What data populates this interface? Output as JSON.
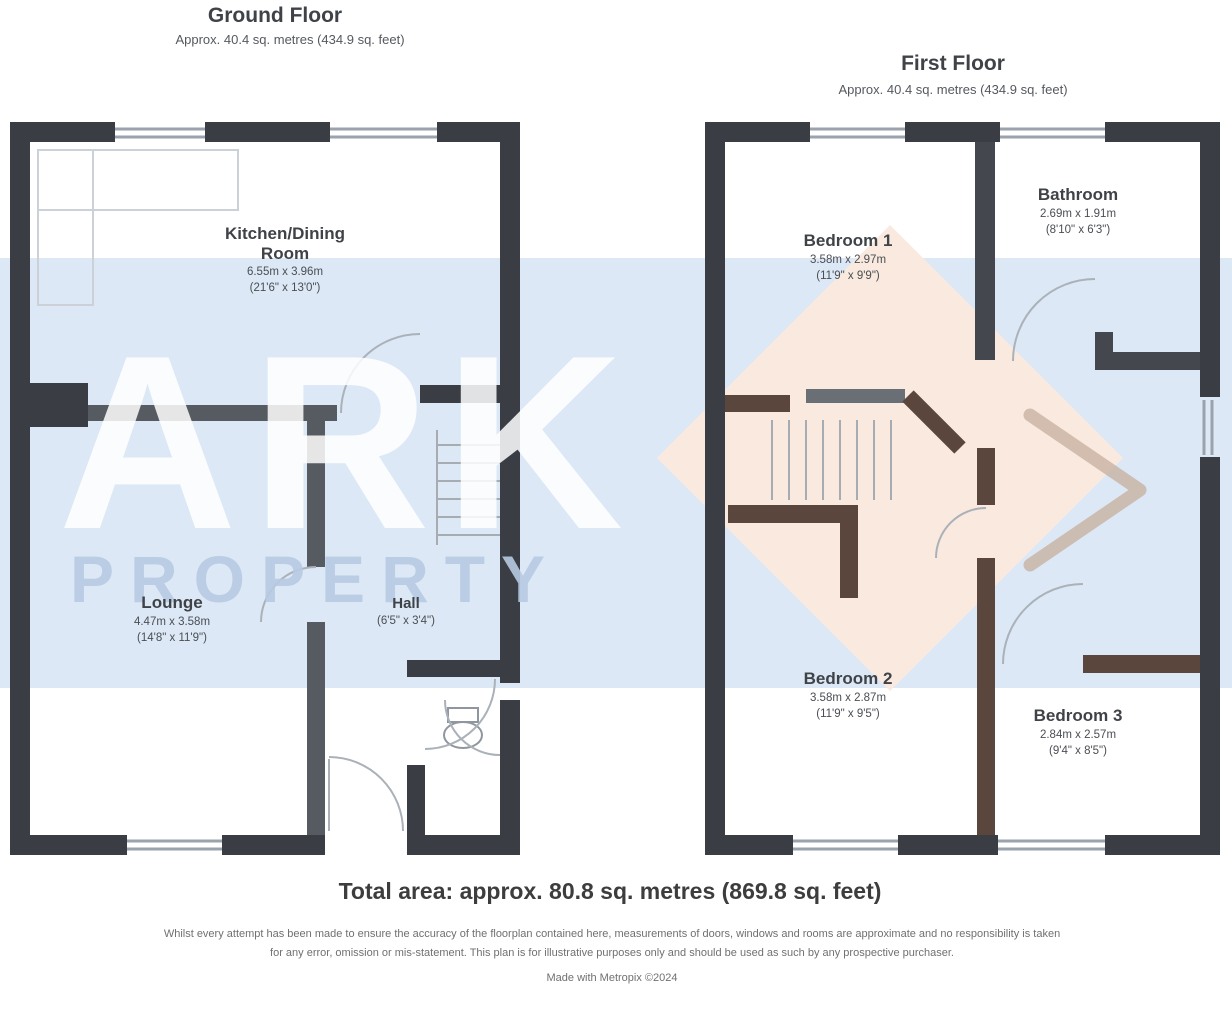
{
  "watermark": {
    "brand_top": "ARK",
    "brand_bottom": "PROPERTY",
    "band_color": "#dce8f5",
    "diamond_color": "#f9e9de",
    "chevron_color": "#c8b2a2"
  },
  "ground_floor": {
    "title": "Ground Floor",
    "subtitle": "Approx. 40.4 sq. metres (434.9 sq. feet)",
    "rooms": [
      {
        "name": "Kitchen/Dining",
        "name2": "Room",
        "dims_metric": "6.55m x 3.96m",
        "dims_imperial": "(21'6\" x 13'0\")"
      },
      {
        "name": "Lounge",
        "dims_metric": "4.47m x 3.58m",
        "dims_imperial": "(14'8\" x 11'9\")"
      },
      {
        "name": "Hall",
        "dims_metric": "1.96m x 1.02m",
        "dims_imperial": "(6'5\" x 3'4\")"
      }
    ]
  },
  "first_floor": {
    "title": "First Floor",
    "subtitle": "Approx. 40.4 sq. metres (434.9 sq. feet)",
    "rooms": [
      {
        "name": "Bedroom 1",
        "dims_metric": "3.58m x 2.97m",
        "dims_imperial": "(11'9\" x 9'9\")"
      },
      {
        "name": "Bathroom",
        "dims_metric": "2.69m x 1.91m",
        "dims_imperial": "(8'10\" x 6'3\")"
      },
      {
        "name": "Bedroom 2",
        "dims_metric": "3.58m x 2.87m",
        "dims_imperial": "(11'9\" x 9'5\")"
      },
      {
        "name": "Bedroom 3",
        "dims_metric": "2.84m x 2.57m",
        "dims_imperial": "(9'4\" x 8'5\")"
      }
    ]
  },
  "footer": {
    "total_area": "Total area: approx. 80.8 sq. metres (869.8 sq. feet)",
    "disclaimer_line1": "Whilst every attempt has been made to ensure the accuracy of the floorplan contained here, measurements of doors, windows and rooms are approximate and no responsibility is taken",
    "disclaimer_line2": "for any error, omission or mis-statement. This plan is for illustrative purposes only and should be used as such by any prospective purchaser.",
    "made_with": "Made with Metropix ©2024"
  }
}
